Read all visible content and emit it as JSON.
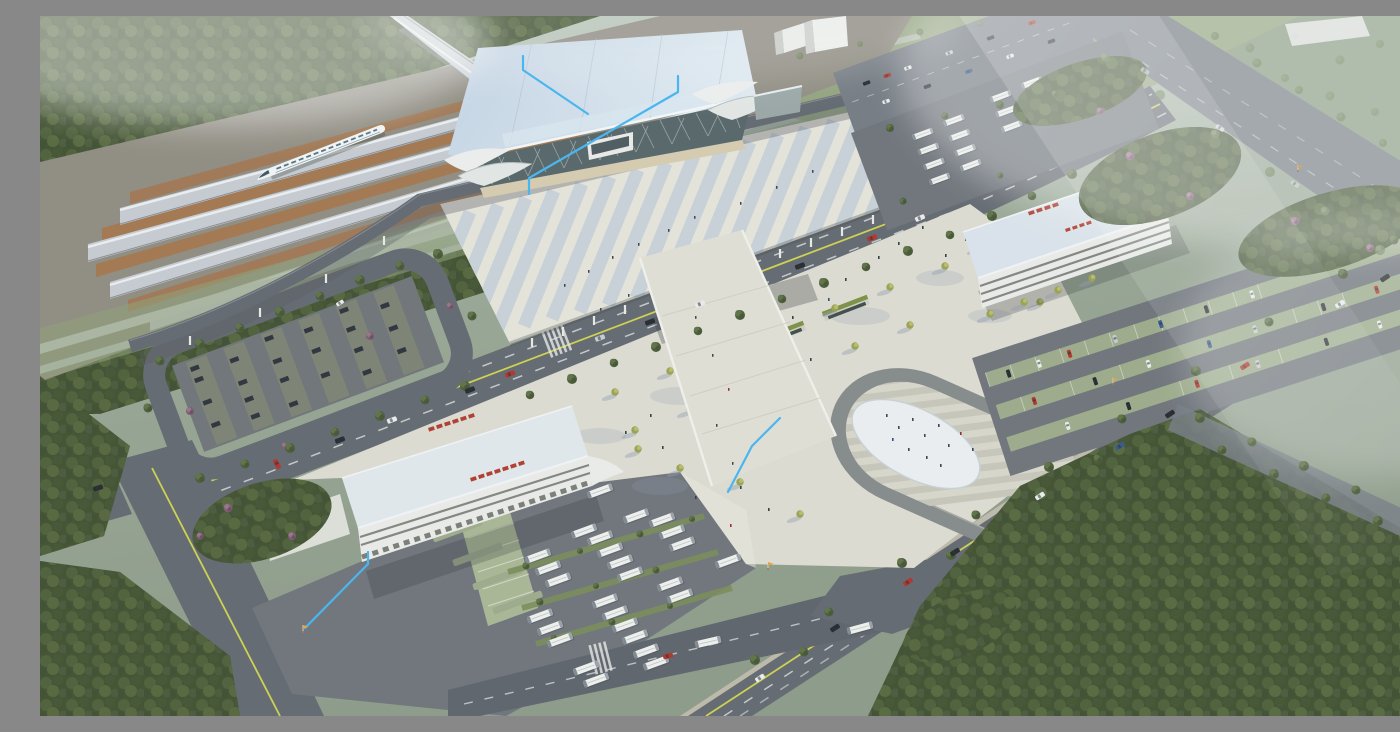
{
  "scene": {
    "type": "aerial-architectural-rendering",
    "title": "Aerial rendering of a high-speed railway station complex",
    "description": "Bird's-eye 3D visualization: diagonal railway corridor with platform canopies and a white high-speed train (top left), blue-roofed glass station hall, striped elevated pedestrian deck, forecourt plaza with lime trees and a horseshoe amphitheater around a white oval, two white buildings with red rooftop signage (bus terminal and transit hub), bus depot with white coaches, car parks, tree-lined arterial roads and dense surrounding forest under atmospheric haze",
    "elements": {
      "railway_platform_canopies": 4,
      "trains": 1,
      "station_hall": 1,
      "elevated_deck": 1,
      "pedestrian_ramp": 1,
      "underpass_entrances": 2,
      "amphitheater": 1,
      "terminal_building_with_red_sign": 1,
      "transit_hub_building_with_red_sign": 1,
      "bus_depot_buses": 25,
      "rear_bus_lot_buses": 17,
      "car_parks": 3,
      "main_roads": 5
    },
    "annotations": {
      "callout_lines": 4,
      "gate_markers": 4
    }
  },
  "palette": {
    "skyTop": "#c3cec4",
    "skyLow": "#98a694",
    "forest": "#41502f",
    "forestHi": "#5a6d41",
    "lawn": "#93a37e",
    "grass": "#8ea077",
    "road": "#63686f",
    "roadLight": "#757b83",
    "pave": "#6e737a",
    "sidewalk": "#c3bead",
    "plaza": "#dfddd2",
    "plazaHi": "#eae8de",
    "shadowBlue": "#8e9cb0",
    "deckA": "#e7e5dc",
    "deckB": "#c9d2d8",
    "roofBlue": "#c3d4e4",
    "roofBlueHi": "#e0eaf3",
    "glass": "#566668",
    "tan": "#d6ccb0",
    "white": "#ecedea",
    "bldgShade": "#b9b9b2",
    "red": "#b23a2c",
    "busWhite": "#f1f2ef",
    "trackBrown": "#a3764f",
    "platform": "#c7ccd2",
    "ridge": "#eef0f2",
    "train": "#f4f6f7",
    "stall": "#9dab8b",
    "stallLight": "#aab795",
    "treeLime": "#9aa351",
    "treeLimeHi": "#b9bd6d",
    "treePurple": "#7c5a6e",
    "yellow": "#cfd24f",
    "dash": "#e8eae8",
    "annotBlue": "#45b6f2",
    "markerOrange": "#f0a23c",
    "stepA": "#d8d7cc",
    "stepB": "#c8c7bb",
    "ringDark": "#85898a",
    "oval": "#ecf0f3",
    "carDark": "#23272c",
    "carWhite": "#eceeee",
    "carRed": "#b33227",
    "carBlue": "#34588f",
    "carSilver": "#c9cdd0"
  }
}
